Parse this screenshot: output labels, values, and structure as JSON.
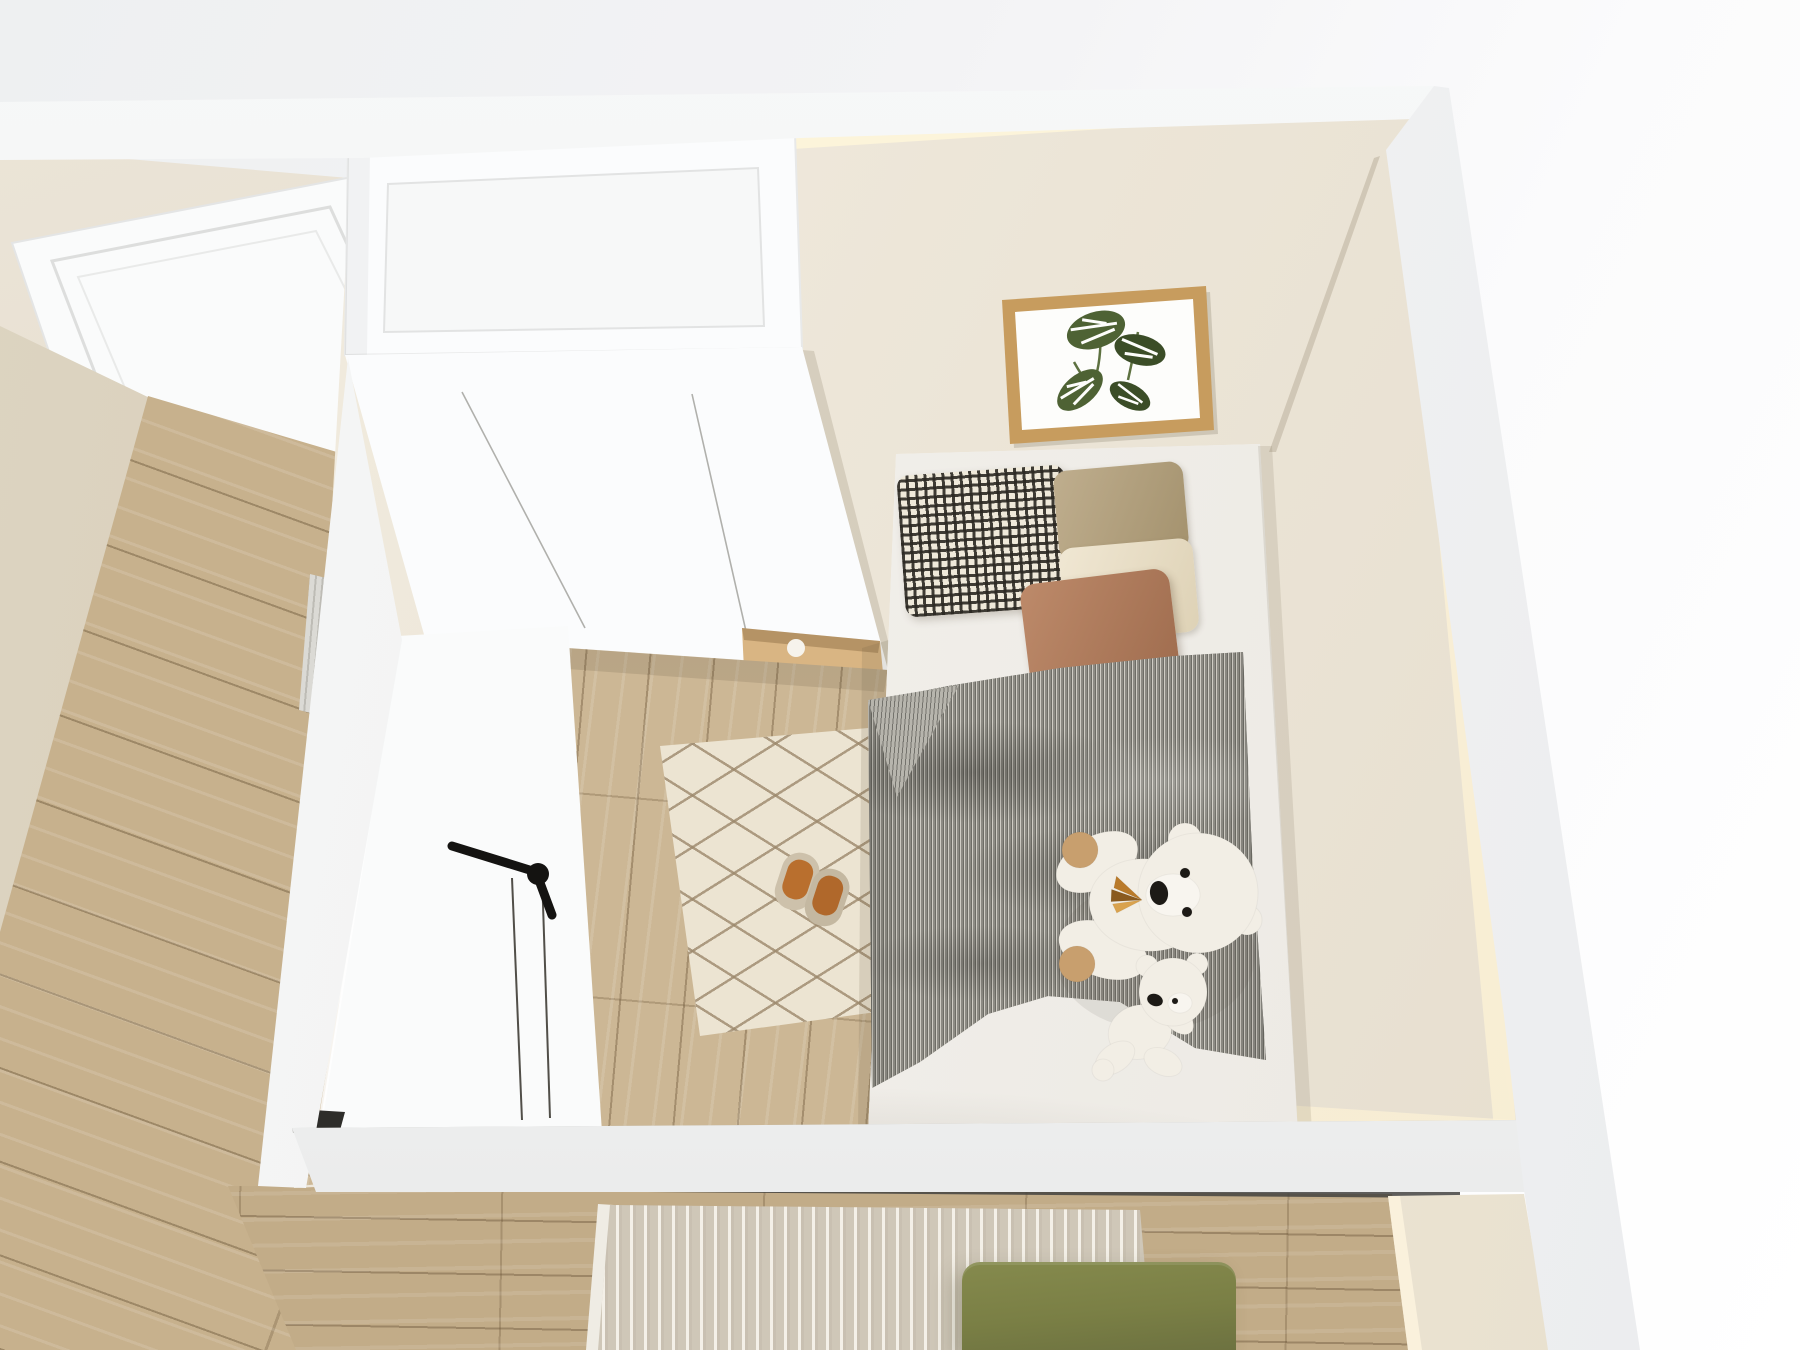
{
  "meta": {
    "description": "Top-down dollhouse-style 3D render of a small bedroom with adjoining hallway and lower room",
    "view": "bird's-eye interior render",
    "width_px": 1800,
    "height_px": 1350
  },
  "palette": {
    "void_white": "#ffffff",
    "wall_band": "#f3f4f4",
    "interior_wall": "#ece5d7",
    "interior_wall_light": "#f3eee2",
    "glow_warm": "#fff3d6",
    "left_wall_beige": "#d6cdb9",
    "hallway_floor": "#c7b18d",
    "bedroom_floor": "#ccb795",
    "lower_floor": "#c2ac88",
    "diamond_rug_base": "#ece4d2",
    "diamond_rug_line": "#9c886c",
    "ribbed_rug_base": "#cfc7b8",
    "ribbed_rug_rib": "#f6f2ea",
    "hall_mat_gray": "#dbdad5",
    "wardrobe_white": "#fbfcfd",
    "wardrobe_panel": "#f7f8f8",
    "wardrobe_seam": "#9e9e99",
    "niche_wood": "#d9b583",
    "niche_wood_dark": "#c09a66",
    "door_white": "#fafbfb",
    "door_seam": "#514f49",
    "handle_black": "#141311",
    "mattress_white": "#f5f3ef",
    "gingham_dark": "#2b2822",
    "gingham_light": "#efe9da",
    "pillow_khaki": "#b2a07f",
    "pillow_cream": "#ece2cc",
    "pillow_terracotta": "#b07a5c",
    "duvet_base": "#8d8b84",
    "duvet_stripe_light": "#cfccc4",
    "duvet_stripe_dark": "#6e6d66",
    "bear_white": "#f2eee5",
    "bear_snout": "#f8f5ef",
    "bear_paw": "#c89f6e",
    "bear_face_dark": "#1d1a16",
    "bow_orange": "#b97a2a",
    "bow_orange_light": "#d9a24e",
    "bow_brown": "#8a5a1f",
    "slipper_beige": "#cdc1ab",
    "slipper_sole": "#b96f2e",
    "ottoman_green": "#7a7f45",
    "ottoman_green_dark": "#6c7140",
    "frame_wood": "#c79c5e",
    "frame_mat": "#fdfdfb",
    "leaf_green": "#4e6234",
    "leaf_green_dark": "#3b4d27",
    "track_dark": "#434240"
  },
  "rooms": {
    "bedroom": {
      "label": "Kids bedroom",
      "objects": [
        {
          "name": "wardrobe",
          "label": "White built-in wardrobe with top cabinet and oak display niche"
        },
        {
          "name": "interior-door",
          "label": "Open white door with black lever handle"
        },
        {
          "name": "bed",
          "label": "Single bed against right wall"
        },
        {
          "name": "pillows",
          "label": "Black-white gingham, khaki, cream and terracotta pillows"
        },
        {
          "name": "duvet",
          "label": "Grey pinstripe duvet"
        },
        {
          "name": "teddy-large",
          "label": "Large white teddy bear with striped bow"
        },
        {
          "name": "teddy-small",
          "label": "Small white teddy bear"
        },
        {
          "name": "diamond-rug",
          "label": "Cream diamond-lattice rug"
        },
        {
          "name": "slippers",
          "label": "Pair of beige slippers with tan soles"
        },
        {
          "name": "wall-art",
          "label": "Oak-framed monstera leaf print"
        },
        {
          "name": "floor",
          "label": "Light oak plank floor"
        }
      ]
    },
    "hallway": {
      "label": "Hallway",
      "objects": [
        {
          "name": "hall-floor",
          "label": "Oak plank floor"
        },
        {
          "name": "hall-wall",
          "label": "Beige wall"
        },
        {
          "name": "hall-mat",
          "label": "Grey woven doormat"
        },
        {
          "name": "hall-door-panel",
          "label": "White panelled door seen from above"
        }
      ]
    },
    "lower_room": {
      "label": "Lower room",
      "objects": [
        {
          "name": "lower-floor",
          "label": "Oak plank floor"
        },
        {
          "name": "ribbed-rug",
          "label": "Beige ribbed area rug"
        },
        {
          "name": "ottoman",
          "label": "Olive green ottoman"
        },
        {
          "name": "door-track",
          "label": "Dark sliding-door track"
        }
      ]
    }
  }
}
